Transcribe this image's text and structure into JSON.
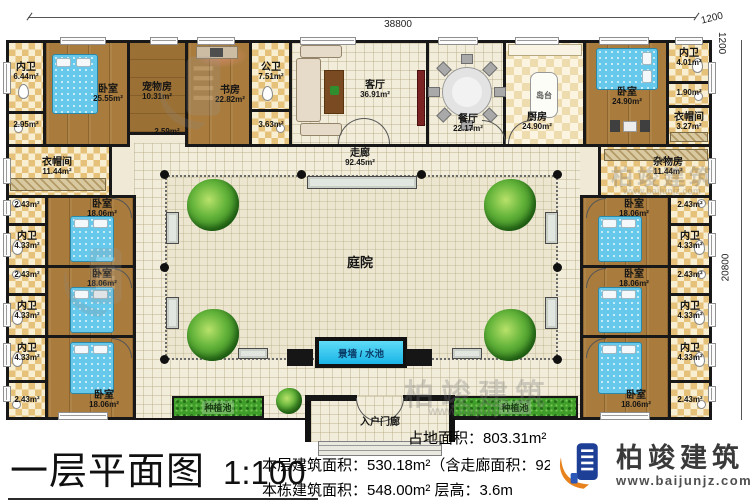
{
  "page": {
    "title": "一层平面图",
    "scale": "1:100",
    "stats": {
      "area_line": "占地面积：803.31m²",
      "floor_line": "本层建筑面积：530.18m²（含走廊面积：92.45m²）",
      "building_line": "本栋建筑面积：548.00m²  层高：3.6m"
    },
    "brand": {
      "name": "柏竣建筑",
      "site": "www.baijunjz.com"
    }
  },
  "dimensions": {
    "top_width": "38800",
    "right_height": "20800",
    "offset_top": "1200",
    "offset_side": "1200"
  },
  "watermark": {
    "name": "柏竣建筑",
    "site": "www.baijunjz.com"
  },
  "rooms": {
    "bath_tl": {
      "name": "内卫",
      "area": "6.44m²"
    },
    "small_tl": {
      "area": "2.95m²"
    },
    "bedroom_tl": {
      "name": "卧室",
      "area": "25.55m²"
    },
    "pet_room": {
      "name": "宠物房",
      "area": "10.31m²"
    },
    "hall_small": {
      "area": "2.59m²"
    },
    "study": {
      "name": "书房",
      "area": "22.82m²"
    },
    "public_bath": {
      "name": "公卫",
      "area": "7.51m²"
    },
    "small_pb": {
      "area": "3.63m²"
    },
    "living": {
      "name": "客厅",
      "area": "36.91m²"
    },
    "dining": {
      "name": "餐厅",
      "area": "22.17m²"
    },
    "kitchen": {
      "name": "厨房",
      "area": "24.90m²"
    },
    "island": {
      "name": "岛台"
    },
    "bedroom_tr": {
      "name": "卧室",
      "area": "24.90m²"
    },
    "bath_tr": {
      "name": "内卫",
      "area": "4.01m²"
    },
    "small_tr": {
      "area": "1.90m²"
    },
    "cloak_tr": {
      "name": "衣帽间",
      "area": "3.27m²"
    },
    "cloak_l": {
      "name": "衣帽间",
      "area": "11.44m²"
    },
    "storage_r": {
      "name": "杂物房",
      "area": "11.44m²"
    },
    "closet_small": {
      "area": "2.43m²"
    },
    "side_bath": {
      "name": "内卫",
      "area": "4.33m²"
    },
    "side_bedroom": {
      "name": "卧室",
      "area": "18.06m²"
    },
    "corridor": {
      "name": "走廊",
      "area": "92.45m²"
    },
    "courtyard": {
      "name": "庭院"
    },
    "water_feature": {
      "name": "景墙 / 水池"
    },
    "planter": {
      "name": "种植池"
    },
    "porch": {
      "name": "入户门廊"
    }
  }
}
